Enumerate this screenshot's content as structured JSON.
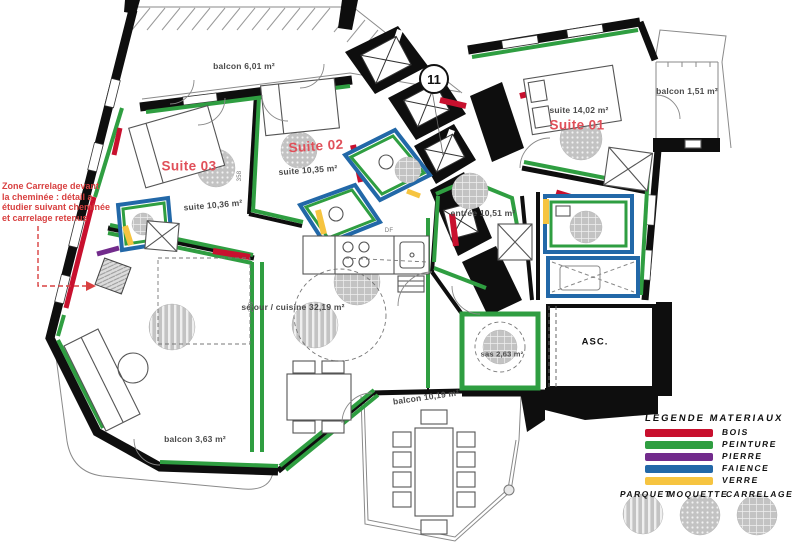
{
  "marker": {
    "number": "11"
  },
  "annotation": {
    "lines": [
      "Zone Carrelage devant",
      "la cheminée : détail a",
      "étudier suivant cheminée",
      "et carrelage retenus"
    ]
  },
  "rooms": {
    "balcon_tl": "balcon 6,01 m²",
    "balcon_tr": "balcon 1,51 m²",
    "balcon_b": "balcon 10,19 m²",
    "balcon_bl": "balcon 3,63 m²",
    "entree": "entrée 10,51 m²",
    "sejour": "séjour / cuisine 32,19 m²",
    "sas": "sas 2,63 m²",
    "asc": "ASC."
  },
  "suites": [
    {
      "name": "Suite 01",
      "area": "suite 14,02 m²"
    },
    {
      "name": "Suite 02",
      "area": "suite 10,35 m²"
    },
    {
      "name": "Suite 03",
      "area": "suite 10,36 m²"
    }
  ],
  "dims": [
    "358",
    "256"
  ],
  "misc": {
    "df": "DF"
  },
  "colors": {
    "bois": "#c8102e",
    "peinture": "#2f9e41",
    "pierre": "#722b8c",
    "faience": "#2268a8",
    "verre": "#f6c440",
    "suite_label": "#e0505a",
    "annotation": "#d84040"
  },
  "legend": {
    "title": "LEGENDE MATERIAUX",
    "materials": [
      {
        "label": "BOIS",
        "color": "#c8102e"
      },
      {
        "label": "PEINTURE",
        "color": "#2f9e41"
      },
      {
        "label": "PIERRE",
        "color": "#722b8c"
      },
      {
        "label": "FAIENCE",
        "color": "#2268a8"
      },
      {
        "label": "VERRE",
        "color": "#f6c440"
      }
    ],
    "floorings": [
      {
        "label": "PARQUET",
        "pattern": "stripes"
      },
      {
        "label": "MOQUETTE",
        "pattern": "dots"
      },
      {
        "label": "CARRELAGE",
        "pattern": "grid"
      }
    ]
  }
}
